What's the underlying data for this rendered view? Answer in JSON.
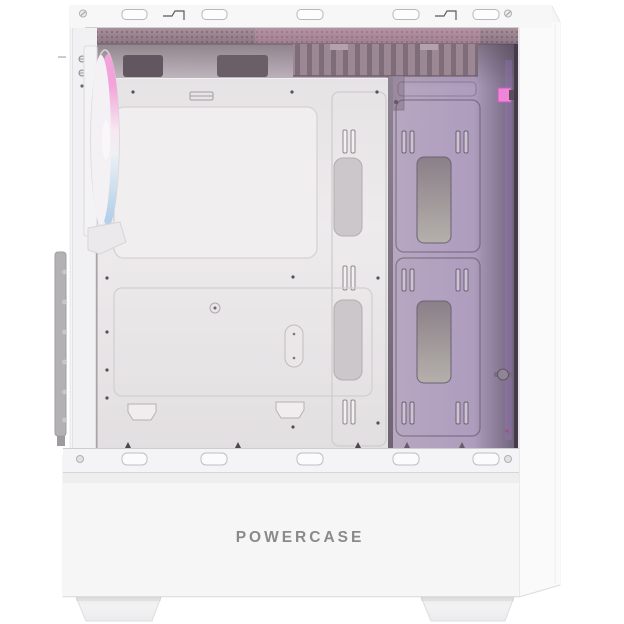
{
  "scene": {
    "type": "product-photo",
    "subject": "White mid-tower PC case with side panel removed showing interior with ARGB lighting",
    "view": "left side, front panel at left"
  },
  "brand": {
    "logo_text": "POWERCASE"
  },
  "colors": {
    "background": "#ffffff",
    "body_white": "#f5f5f6",
    "rim_white": "#f7f7f8",
    "interior_left": "#cfc8cd",
    "interior_right": "#a898bd",
    "tray_white": "#eae7e9",
    "mesh_mauve": "#9b8791",
    "logo_color": "#8a8a8a",
    "fan_pink": "#f2a4da",
    "fan_white": "#f7e9f1",
    "fan_blue": "#b4d0ea",
    "accent_connector": "#ee85d9"
  },
  "case": {
    "top_rim": {
      "slot_count": 5,
      "latch_count": 2,
      "screw_count": 2
    },
    "bottom_rail": {
      "slot_count": 5,
      "hole_count": 2
    },
    "feet_count": 2,
    "front_fan": {
      "position": "front-top",
      "lighting": "argb",
      "glow": [
        "#f2a4da",
        "#f7e9f1",
        "#b4d0ea"
      ]
    },
    "motherboard_tray": {
      "cpu_cutout": 1,
      "cable_grommets": 2,
      "tie_slot_rows": 3
    },
    "rear_panel": {
      "drive_cutouts": 2,
      "tie_slot_rows": 3,
      "thumbscrews": 1,
      "argb_connector": 1
    }
  }
}
